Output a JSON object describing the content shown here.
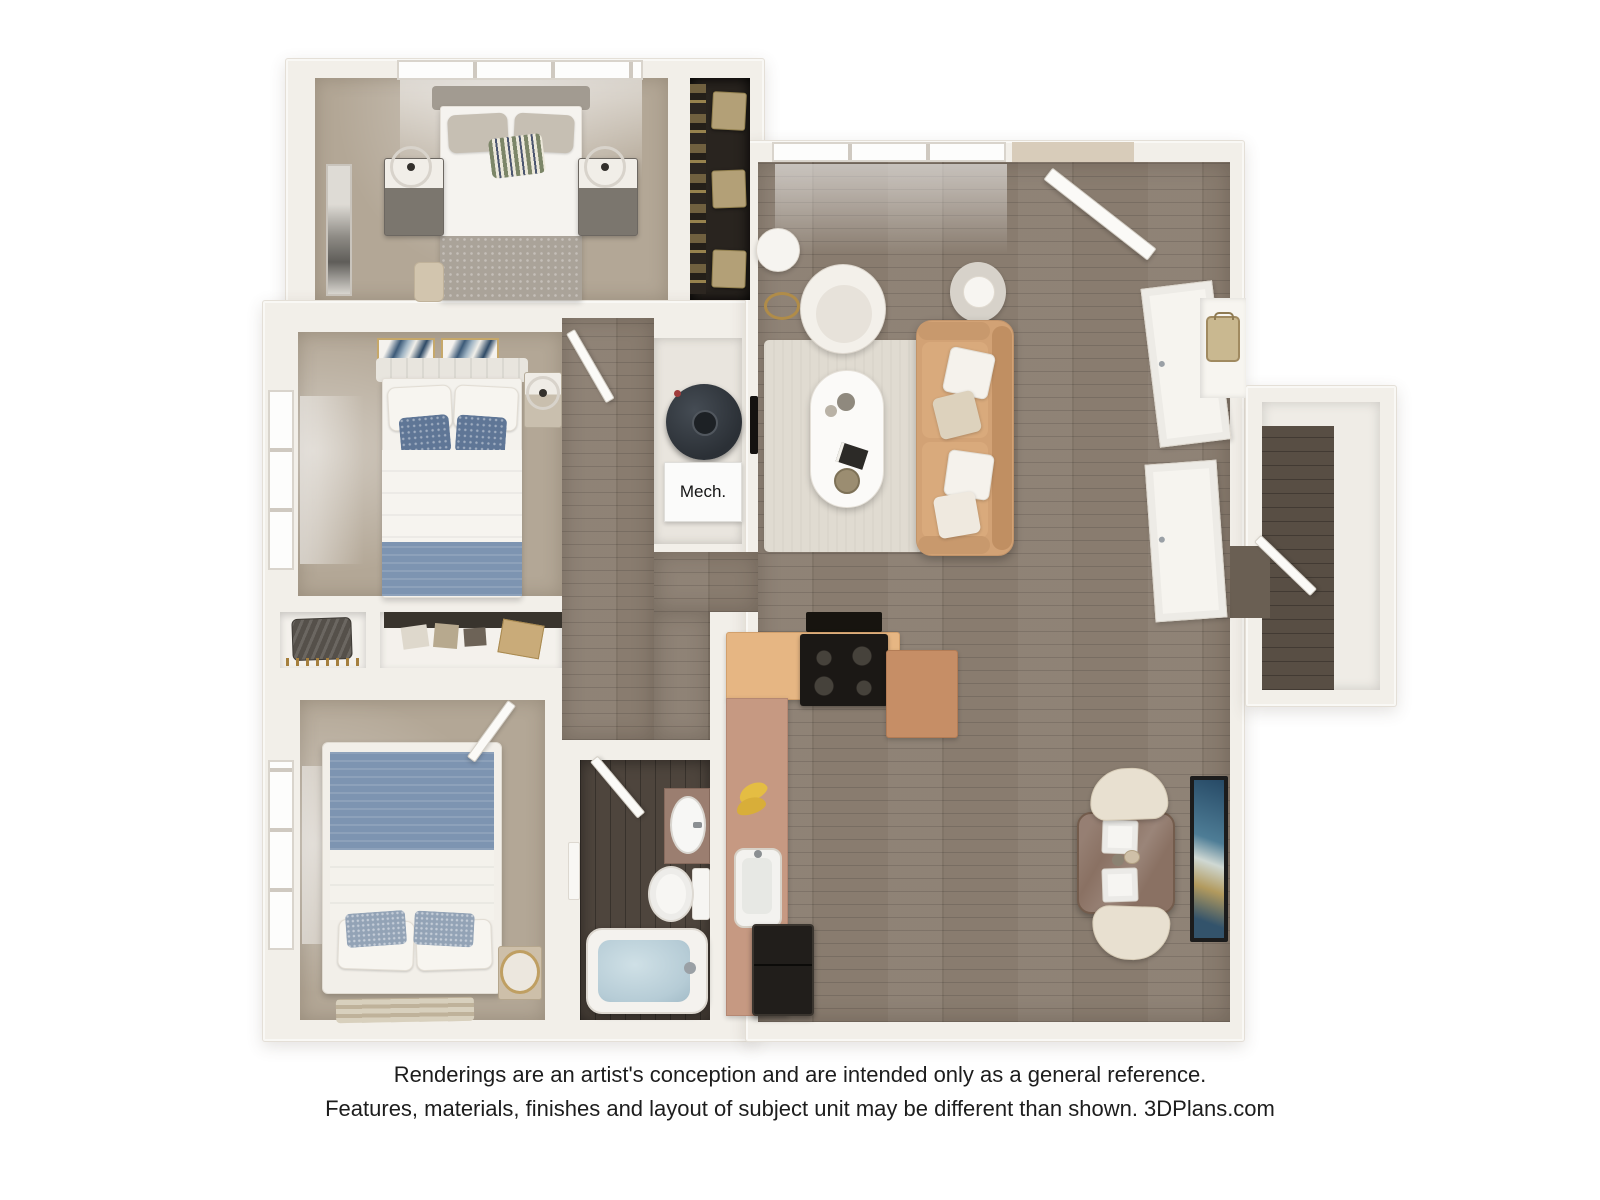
{
  "labels": {
    "mech_closet": "Mech."
  },
  "disclaimer": {
    "line1": "Renderings are an artist's conception and are intended only as a general reference.",
    "line2": "Features, materials, finishes and layout of subject unit may be different than shown. 3DPlans.com"
  },
  "palette": {
    "background": "#ffffff",
    "walls": "#f2efe9",
    "bedroom_carpet": "#b3a796",
    "main_wood_floor": "#897c6f",
    "bathroom_floor": "#4e453d",
    "closet_interior": "#29241f",
    "sofa_tan": "#d2a275",
    "armchair_white": "#f3f0ea",
    "area_rug": "#e0dbd1",
    "kitchen_counter_tan": "#e6b683",
    "kitchen_counter_mauve": "#c69982",
    "kitchen_peninsula": "#c68e66",
    "appliance_black": "#1b1815",
    "bed_blanket_blue": "#7d94b1",
    "accent_pillow_blue": "#5f7696",
    "tub_water_blue": "#b6ccd6",
    "dining_table_brown": "#8a7163",
    "dining_chair_cream": "#e8e0d0",
    "gold_accent": "#b3a077",
    "artwork_navy": "#2e4a66"
  },
  "plan": {
    "type": "3d-floor-plan-rendering",
    "view": "top-down",
    "rooms": [
      {
        "name": "bedroom-1",
        "position": "top-left",
        "furniture": [
          "queen-bed",
          "nightstand-left",
          "nightstand-right",
          "ring-lamp-left",
          "ring-lamp-right",
          "wall-art",
          "bench",
          "window",
          "closet-with-gold-boxes"
        ]
      },
      {
        "name": "bedroom-2",
        "position": "middle-left",
        "furniture": [
          "queen-bed-blue-blanket",
          "two-art-frames",
          "nightstand-with-lamp",
          "window",
          "double-closet"
        ]
      },
      {
        "name": "bedroom-3",
        "position": "bottom-left",
        "furniture": [
          "queen-bed-blue-blanket",
          "nightstand",
          "round-mirror",
          "striped-rug",
          "window"
        ]
      },
      {
        "name": "bathroom",
        "position": "bottom-center",
        "furniture": [
          "vanity-sink",
          "toilet",
          "bathtub",
          "towel"
        ]
      },
      {
        "name": "mechanical-closet",
        "position": "center",
        "furniture": [
          "water-heater",
          "mech-label-box"
        ]
      },
      {
        "name": "living-room",
        "position": "top-right",
        "furniture": [
          "tan-sofa",
          "round-armchair",
          "oval-coffee-table",
          "area-rug",
          "floor-lamp",
          "side-table-lamp",
          "wall-tv",
          "windows",
          "open-entry-door"
        ]
      },
      {
        "name": "kitchen",
        "position": "bottom-center-right",
        "furniture": [
          "l-shaped-counter",
          "gas-range",
          "range-hood",
          "sink",
          "bananas",
          "refrigerator",
          "peninsula"
        ]
      },
      {
        "name": "dining-area",
        "position": "bottom-right",
        "furniture": [
          "square-table",
          "two-place-settings",
          "two-cream-chairs",
          "tall-wall-art"
        ]
      },
      {
        "name": "hallway",
        "position": "center",
        "furniture": [
          "open-doors"
        ]
      },
      {
        "name": "entry-closets",
        "position": "right",
        "furniture": [
          "two-sliding-doors",
          "shelf-niche-with-bag"
        ]
      },
      {
        "name": "storage-nook",
        "position": "far-right",
        "furniture": [
          "open-door",
          "wood-floor"
        ]
      }
    ]
  }
}
